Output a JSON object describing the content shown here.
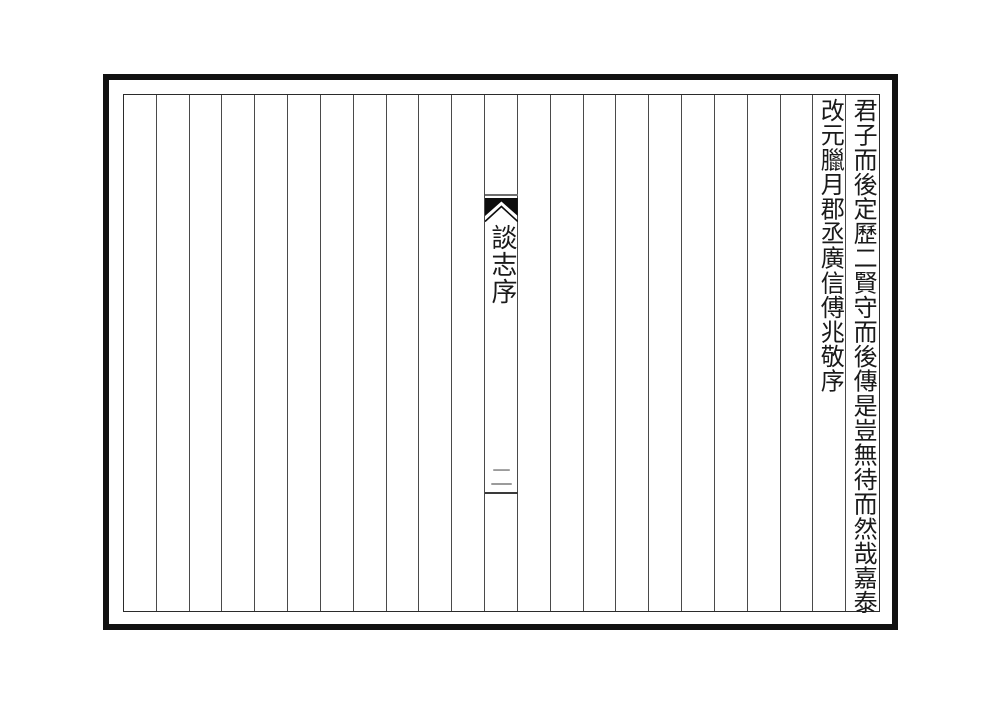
{
  "page": {
    "kind": "scanned classical Chinese book page (preface leaf)",
    "background_color": "#ffffff"
  },
  "frame": {
    "outer_border_color": "#111111",
    "inner_border_color": "#2b2b2b",
    "column_line_color": "#4a4a4a",
    "column_count": 23
  },
  "content": {
    "text_columns": [
      {
        "position_from_left": 23,
        "text": "君子而後定歷二賢守而後傳是豈無待而然哉嘉泰"
      },
      {
        "position_from_left": 22,
        "text": "改元臘月郡丞廣信傅兆敬序"
      }
    ],
    "text_color": "#1a1a1a"
  },
  "banxin": {
    "position_from_left": 12,
    "icons": {
      "fishtail": "black-fishtail-mark"
    },
    "fishtail_color": "#0d0d0d",
    "top_rule_color": "#6e6e6e",
    "title": "談志序",
    "page_number": "二",
    "page_number_color": "#9b9b9b",
    "bottom_rule_color": "#3a3a3a"
  }
}
